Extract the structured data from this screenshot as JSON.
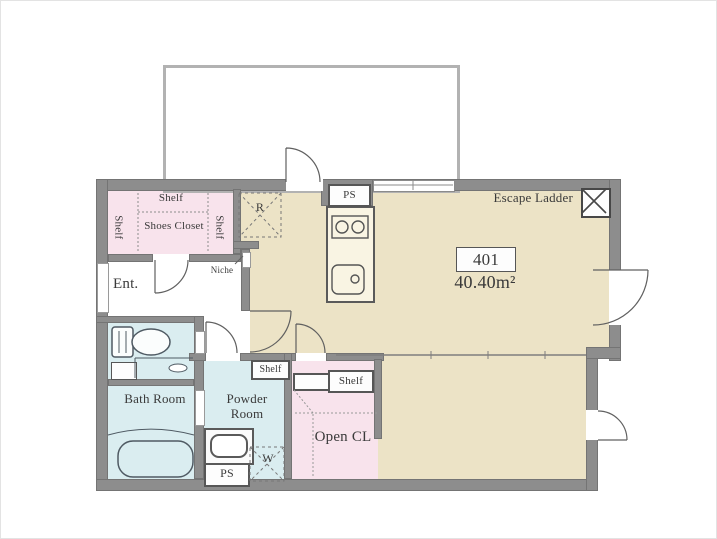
{
  "plan": {
    "unit_number": "401",
    "area": "40.40m²",
    "labels": {
      "escape_ladder": "Escape Ladder",
      "entrance": "Ent.",
      "niche": "Niche",
      "bath_room": "Bath Room",
      "powder_room": "Powder Room",
      "open_closet": "Open CL",
      "shoes_closet": "Shoes Closet",
      "shelf": "Shelf",
      "refrigerator": "R",
      "washer": "W",
      "pipe_space": "PS"
    },
    "colors": {
      "room_beige": "#ece3c6",
      "closet_pink": "#f8e3ec",
      "wet_blue": "#daedf0",
      "wall_gray": "#8d8d8d",
      "line_gray": "#5f5f5f"
    }
  }
}
